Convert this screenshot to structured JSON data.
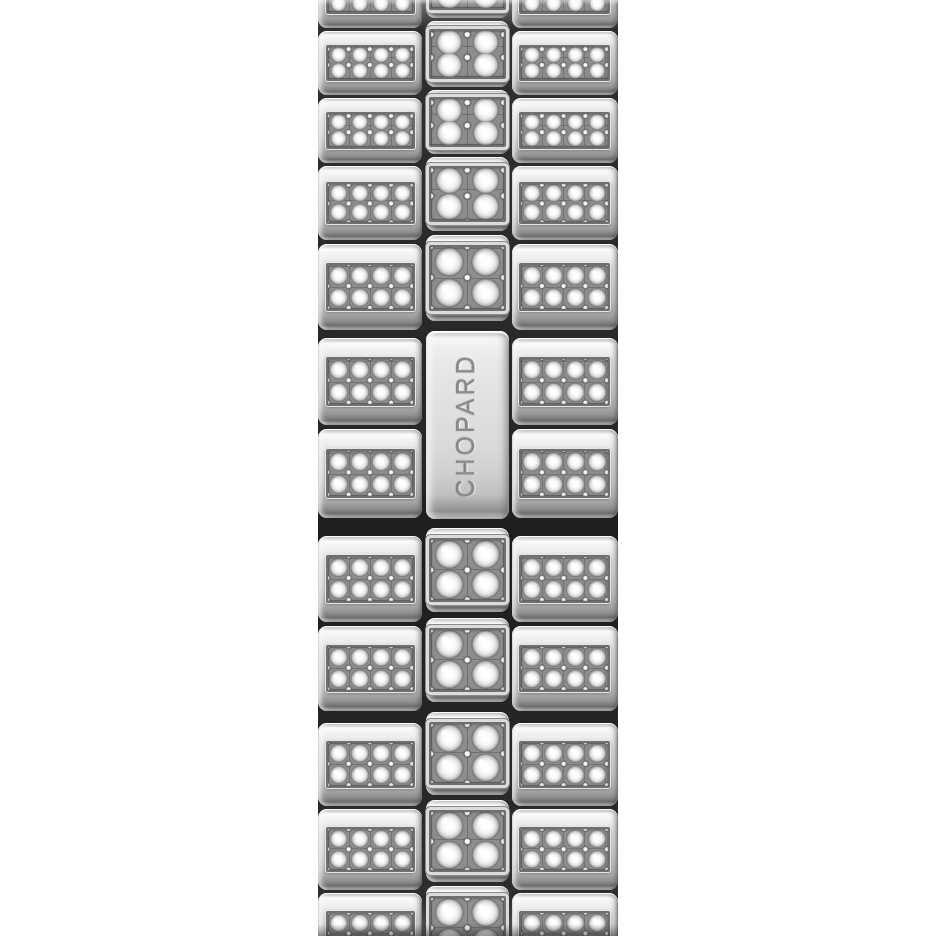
{
  "image": {
    "description": "Macro product photo of a polished steel Chopard watch bracelet fully set with diamond pave links, on a white background",
    "background": "#ffffff"
  },
  "bracelet": {
    "engraving": "CHOPARD",
    "engraving_orientation": "vertical, reads bottom-to-top",
    "palette": {
      "metal_highlight": "#fbfbfb",
      "metal_mid": "#d6d6d6",
      "metal_shadow": "#6e6e6e",
      "groove": "#262626",
      "pave_bed": "#8d8d8d",
      "diamond": "#ffffff",
      "engraving_text": "#8d8d8d"
    },
    "columns": [
      {
        "id": "left",
        "pave_grid": {
          "rows": 2,
          "cols": 4
        }
      },
      {
        "id": "center",
        "pave_grid": {
          "rows": 2,
          "cols": 2
        }
      },
      {
        "id": "right",
        "pave_grid": {
          "rows": 2,
          "cols": 4
        }
      }
    ],
    "left_rows": [
      {
        "kind": "partial-top",
        "h": 28,
        "mt": 0
      },
      {
        "kind": "pave",
        "h": 64,
        "mt": 3
      },
      {
        "kind": "pave",
        "h": 65,
        "mt": 3
      },
      {
        "kind": "pave",
        "h": 74,
        "mt": 3
      },
      {
        "kind": "pave",
        "h": 86,
        "mt": 4
      },
      {
        "kind": "pave",
        "h": 87,
        "mt": 8
      },
      {
        "kind": "pave",
        "h": 89,
        "mt": 4
      },
      {
        "kind": "pave",
        "h": 86,
        "mt": 18
      },
      {
        "kind": "pave",
        "h": 85,
        "mt": 4
      },
      {
        "kind": "pave",
        "h": 83,
        "mt": 12
      },
      {
        "kind": "pave",
        "h": 81,
        "mt": 3
      },
      {
        "kind": "partial-bottom",
        "h": 43,
        "mt": 3
      }
    ],
    "center_rows": [
      {
        "kind": "partial-top",
        "h": 18,
        "mt": 0
      },
      {
        "kind": "pave",
        "h": 66,
        "mt": 3
      },
      {
        "kind": "pave",
        "h": 64,
        "mt": 3
      },
      {
        "kind": "pave",
        "h": 74,
        "mt": 3
      },
      {
        "kind": "pave",
        "h": 86,
        "mt": 4
      },
      {
        "kind": "clasp",
        "h": 188,
        "mt": 10
      },
      {
        "kind": "pave",
        "h": 84,
        "mt": 9
      },
      {
        "kind": "pave",
        "h": 84,
        "mt": 6
      },
      {
        "kind": "pave",
        "h": 83,
        "mt": 10
      },
      {
        "kind": "pave",
        "h": 82,
        "mt": 5
      },
      {
        "kind": "partial-bottom",
        "h": 50,
        "mt": 4
      }
    ],
    "right_rows": [
      {
        "kind": "partial-top",
        "h": 28,
        "mt": 0
      },
      {
        "kind": "pave",
        "h": 64,
        "mt": 3
      },
      {
        "kind": "pave",
        "h": 65,
        "mt": 3
      },
      {
        "kind": "pave",
        "h": 74,
        "mt": 3
      },
      {
        "kind": "pave",
        "h": 86,
        "mt": 4
      },
      {
        "kind": "pave",
        "h": 87,
        "mt": 8
      },
      {
        "kind": "pave",
        "h": 89,
        "mt": 4
      },
      {
        "kind": "pave",
        "h": 86,
        "mt": 18
      },
      {
        "kind": "pave",
        "h": 85,
        "mt": 4
      },
      {
        "kind": "pave",
        "h": 83,
        "mt": 12
      },
      {
        "kind": "pave",
        "h": 81,
        "mt": 3
      },
      {
        "kind": "partial-bottom",
        "h": 43,
        "mt": 3
      }
    ]
  }
}
